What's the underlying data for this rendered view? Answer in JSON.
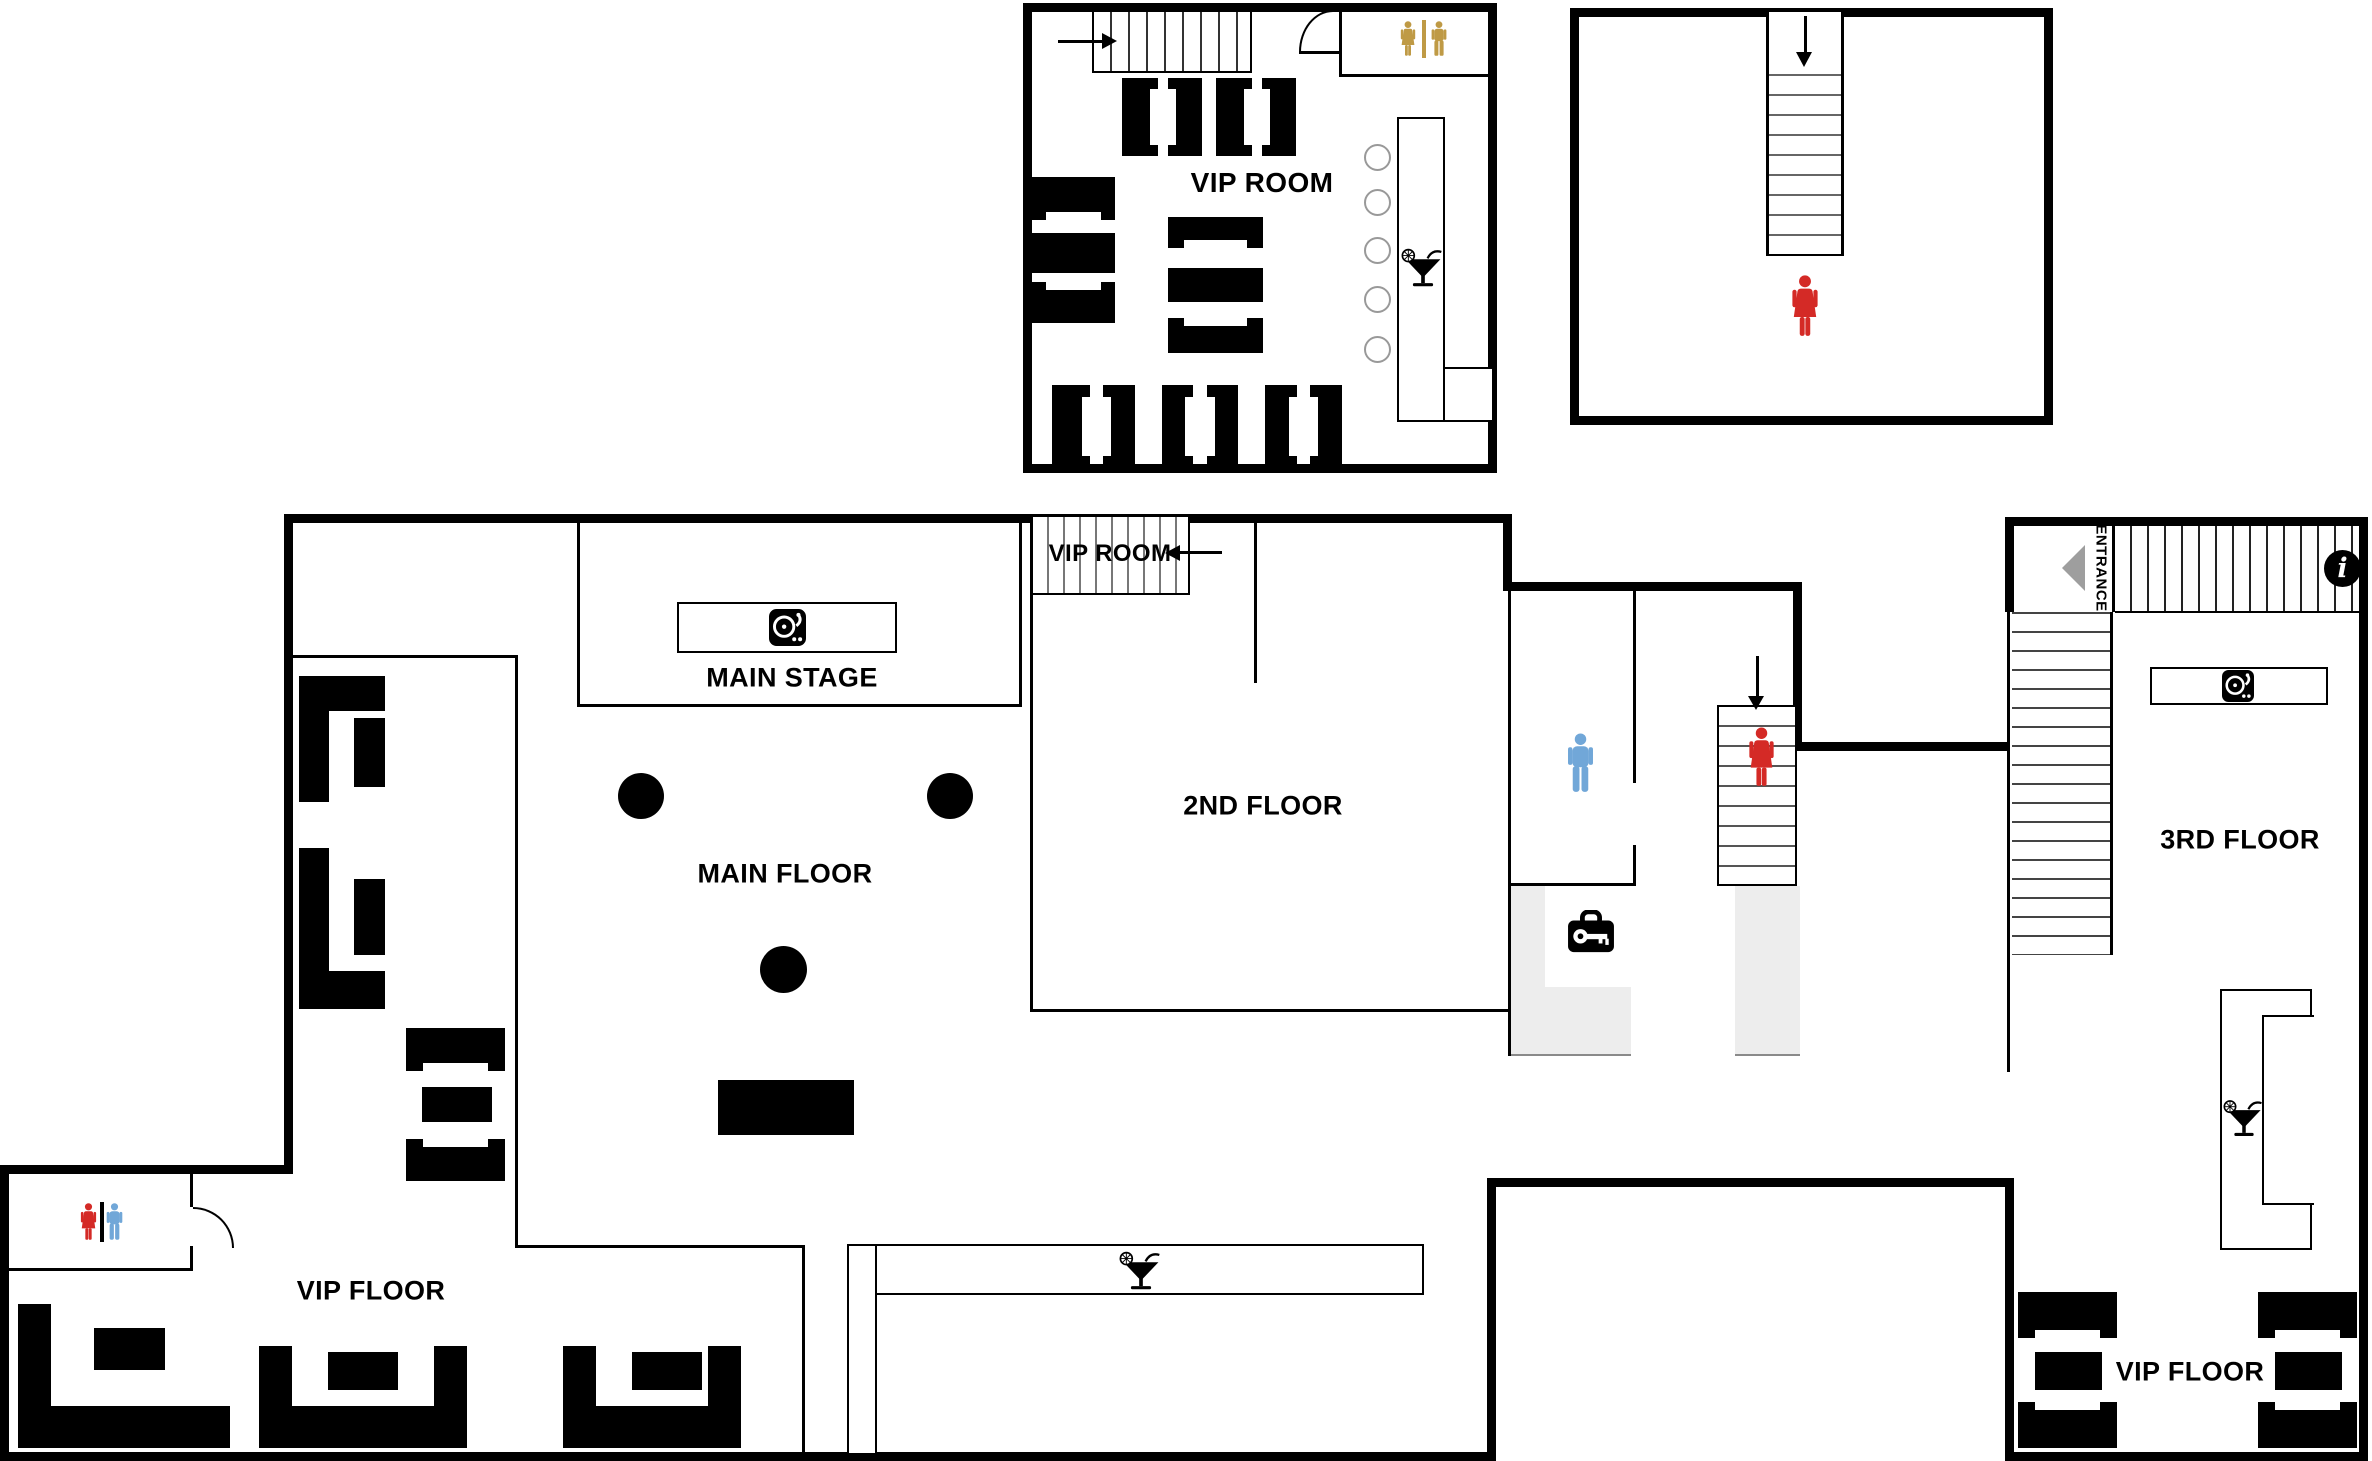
{
  "labels": {
    "vip_room_upper": "VIP ROOM",
    "vip_room_stairs": "VIP ROOM",
    "main_stage": "MAIN STAGE",
    "main_floor": "MAIN FLOOR",
    "second_floor": "2ND FLOOR",
    "vip_floor_left": "VIP FLOOR",
    "third_floor": "3RD FLOOR",
    "vip_floor_right": "VIP FLOOR",
    "entrance": "ENTRANCE",
    "info_glyph": "i"
  },
  "colors": {
    "wall": "#000000",
    "women_icon": "#d42a26",
    "men_icon": "#71a7d8",
    "unisex_restroom_icon": "#bf9a45",
    "corridor_fill": "#ededed",
    "stair_line": "#555555",
    "entrance_arrow": "#9e9e9e",
    "stool_ring": "#999999"
  },
  "icons": {
    "turntable": "dj-turntable",
    "martini": "cocktail-glass-with-lemon",
    "woman": "woman-pictogram",
    "man": "man-pictogram",
    "coat_check": "key-case",
    "info": "info-circle",
    "arrows": [
      "arrow-right",
      "arrow-down",
      "arrow-left",
      "entrance-arrow-left"
    ]
  },
  "rooms": [
    {
      "name": "vip-room-upper",
      "label": "VIP ROOM"
    },
    {
      "name": "stair-room-upper-right",
      "label": ""
    },
    {
      "name": "main-stage",
      "label": "MAIN STAGE"
    },
    {
      "name": "main-floor",
      "label": "MAIN FLOOR"
    },
    {
      "name": "second-floor",
      "label": "2ND FLOOR"
    },
    {
      "name": "vip-floor-left",
      "label": "VIP FLOOR"
    },
    {
      "name": "third-floor",
      "label": "3RD FLOOR"
    },
    {
      "name": "vip-floor-right",
      "label": "VIP FLOOR"
    }
  ]
}
